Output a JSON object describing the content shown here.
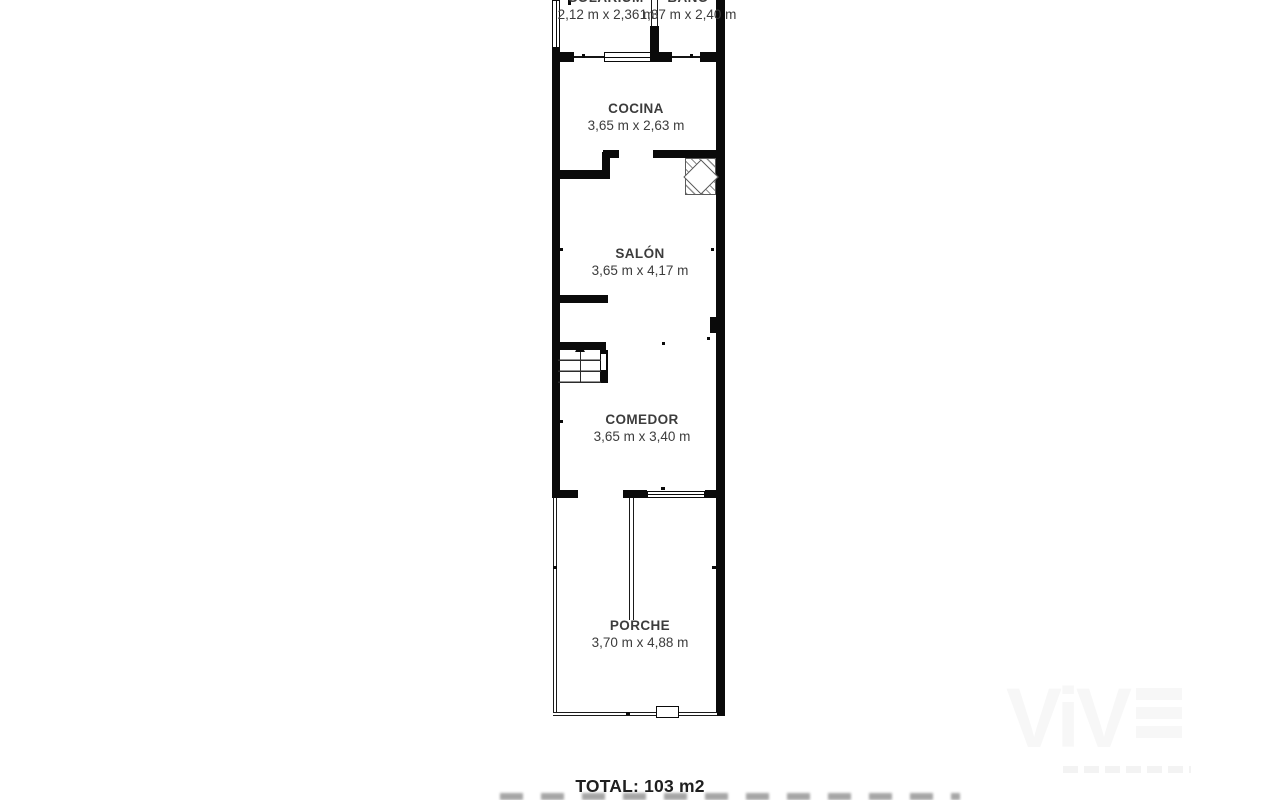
{
  "plan": {
    "rooms": [
      {
        "name": "SOLARIUM",
        "dims": "2,12 m x 2,36 m"
      },
      {
        "name": "BAÑO",
        "dims": "1,37 m x 2,40 m"
      },
      {
        "name": "COCINA",
        "dims": "3,65 m x 2,63 m"
      },
      {
        "name": "SALÓN",
        "dims": "3,65 m x 4,17 m"
      },
      {
        "name": "COMEDOR",
        "dims": "3,65 m x 3,40 m"
      },
      {
        "name": "PORCHE",
        "dims": "3,70 m x 4,88 m"
      }
    ],
    "total_label": "TOTAL: 103 m2"
  },
  "watermark": {
    "text": "ViV"
  },
  "colors": {
    "wall": "#0a0a0a",
    "room_text": "#3c3c3c",
    "total_text": "#1f1f1f",
    "watermark": "#f7f7f7",
    "background": "#ffffff"
  }
}
